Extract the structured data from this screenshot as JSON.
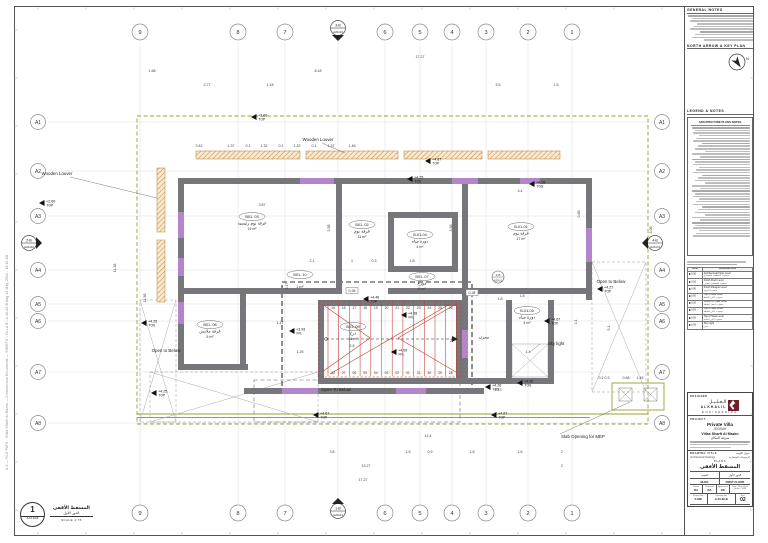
{
  "colors": {
    "wall": "#76767b",
    "purple": "#b286c8",
    "olive": "#9aa031",
    "red": "#c4382f",
    "hatch": "#cf8b3e",
    "hatch_bg": "#f7ead2",
    "logo": "#6e1f2a"
  },
  "sheet": {
    "file_path": "A-2  —  FILE PATH : Villas Sharft Al Mazkn — Construction Documents — SHEETS \\ VILLA B \\ A-10-02-B.dwg   13 May, 2014 - 10:15 AM"
  },
  "grid": {
    "top": [
      "9",
      "8",
      "7",
      "6",
      "5",
      "4",
      "3",
      "2",
      "1"
    ],
    "bottom": [
      "9",
      "8",
      "7",
      "6",
      "5",
      "4",
      "3",
      "2",
      "1"
    ],
    "left": [
      "A1",
      "A2",
      "A3",
      "A4",
      "A5",
      "A6",
      "A7",
      "A8"
    ],
    "right": [
      "A1",
      "A2",
      "A3",
      "A4",
      "A5",
      "A6",
      "A7",
      "A8"
    ],
    "section_markers": [
      {
        "name": "3-B",
        "ref": "A20-03",
        "dir": "down",
        "x": 338,
        "y": 28
      },
      {
        "name": "1-B",
        "ref": "A20-01",
        "dir": "up",
        "x": 338,
        "y": 511
      },
      {
        "name": "2-B",
        "ref": "A20-02",
        "dir": "right",
        "x": 29,
        "y": 243
      },
      {
        "name": "4-B",
        "ref": "A20-04",
        "dir": "left",
        "x": 655,
        "y": 243
      }
    ],
    "ref_tag": {
      "top": "1-B",
      "bot": "A30-01",
      "x": 498,
      "y": 277
    }
  },
  "plan": {
    "labels": [
      {
        "id": "wooden-louver-top",
        "t": "Wooden Louver",
        "x": 318,
        "y": 141
      },
      {
        "id": "wooden-louver-left",
        "t": "Wooden Louver",
        "x": 57,
        "y": 175
      },
      {
        "id": "open-below-left",
        "t": "Open to Below",
        "x": 166,
        "y": 352
      },
      {
        "id": "open-below-bottom",
        "t": "Open To Below",
        "x": 336,
        "y": 391
      },
      {
        "id": "open-below-right",
        "t": "Open to Below",
        "x": 611,
        "y": 283
      },
      {
        "id": "sky-light",
        "t": "Sky light",
        "x": 556,
        "y": 345
      },
      {
        "id": "slab-mep",
        "t": "Slab Opening for MEP",
        "x": 583,
        "y": 438
      }
    ],
    "rooms": [
      {
        "id": "B01- 03",
        "name": "غرفة نوم رئيسية",
        "area": "19 m²",
        "x": 252,
        "y": 218
      },
      {
        "id": "B01- 02",
        "name": "غرفة نوم",
        "area": "11 m²",
        "x": 362,
        "y": 226
      },
      {
        "id": "B-01-04",
        "name": "دورة مياه",
        "area": "4 m²",
        "x": 420,
        "y": 236
      },
      {
        "id": "B-01-01",
        "name": "غرفة نوم",
        "area": "17 m²",
        "x": 521,
        "y": 228
      },
      {
        "id": "B01- 07",
        "name": "موزع",
        "area": "5 m²",
        "x": 422,
        "y": 278
      },
      {
        "id": "B01- 10",
        "name": "",
        "area": "1 m²",
        "x": 300,
        "y": 276
      },
      {
        "id": "B01- 08",
        "name": "غرفة ملابس",
        "area": "5 m²",
        "x": 210,
        "y": 326
      },
      {
        "id": "B01- 09",
        "name": "درج",
        "area": "16 m²",
        "x": 353,
        "y": 328
      },
      {
        "id": "",
        "name": "مخزن",
        "area": "",
        "x": 484,
        "y": 332
      },
      {
        "id": "B-01-05",
        "name": "دورة مياه",
        "area": "4 m²",
        "x": 527,
        "y": 312
      }
    ],
    "level_markers": [
      {
        "v": "+2.68",
        "s": "TOP",
        "x": 258,
        "y": 113
      },
      {
        "v": "+2.60",
        "s": "TOP",
        "x": 46,
        "y": 199
      },
      {
        "v": "+4.87",
        "s": "TOP",
        "x": 432,
        "y": 157
      },
      {
        "v": "+4.25",
        "s": "TOS",
        "x": 414,
        "y": 175
      },
      {
        "v": "+4.26",
        "s": "TOS",
        "x": 536,
        "y": 180
      },
      {
        "v": "+4.25",
        "s": "TOS",
        "x": 148,
        "y": 319
      },
      {
        "v": "+4.46",
        "s": "TOP",
        "x": 370,
        "y": 295
      },
      {
        "v": "+4.38",
        "s": "FFL",
        "x": 408,
        "y": 311
      },
      {
        "v": "+3.93",
        "s": "FFL",
        "x": 296,
        "y": 327
      },
      {
        "v": "+4.09",
        "s": "FFL",
        "x": 398,
        "y": 348
      },
      {
        "v": "+4.27",
        "s": "TOP",
        "x": 604,
        "y": 285
      },
      {
        "v": "+4.67",
        "s": "TOP",
        "x": 551,
        "y": 317
      },
      {
        "v": "+4.26",
        "s": "TOS",
        "x": 492,
        "y": 383
      },
      {
        "v": "+4.67",
        "s": "TOP",
        "x": 320,
        "y": 411
      },
      {
        "v": "+4.67",
        "s": "TOP",
        "x": 498,
        "y": 411
      },
      {
        "v": "+4.25",
        "s": "TOP",
        "x": 158,
        "y": 389
      },
      {
        "v": "+4.25",
        "s": "TOS",
        "x": 524,
        "y": 379
      }
    ],
    "dimensions": [
      {
        "t": "17.27",
        "x": 420,
        "y": 58
      },
      {
        "t": "1.68",
        "x": 152,
        "y": 72
      },
      {
        "t": "8.18",
        "x": 318,
        "y": 72
      },
      {
        "t": "3.77",
        "x": 207,
        "y": 86
      },
      {
        "t": "1.18",
        "x": 270,
        "y": 86
      },
      {
        "t": "3.5",
        "x": 498,
        "y": 86
      },
      {
        "t": "1.5",
        "x": 556,
        "y": 86
      },
      {
        "t": "3.42",
        "x": 199,
        "y": 147
      },
      {
        "t": "1.37",
        "x": 231,
        "y": 147
      },
      {
        "t": "0.1",
        "x": 248,
        "y": 147
      },
      {
        "t": "1.32",
        "x": 264,
        "y": 147
      },
      {
        "t": "0.1",
        "x": 281,
        "y": 147
      },
      {
        "t": "1.32",
        "x": 297,
        "y": 147
      },
      {
        "t": "0.1",
        "x": 314,
        "y": 147
      },
      {
        "t": "1.37",
        "x": 331,
        "y": 147
      },
      {
        "t": "1.46",
        "x": 352,
        "y": 147
      },
      {
        "t": "3.87",
        "x": 262,
        "y": 206
      },
      {
        "t": "3.58",
        "x": 330,
        "y": 228,
        "r": 1
      },
      {
        "t": "3.38",
        "x": 452,
        "y": 228,
        "r": 1
      },
      {
        "t": "3.4",
        "x": 520,
        "y": 192
      },
      {
        "t": "0.88",
        "x": 580,
        "y": 214,
        "r": 1
      },
      {
        "t": "2.1",
        "x": 312,
        "y": 262
      },
      {
        "t": "1",
        "x": 352,
        "y": 262
      },
      {
        "t": "0.3",
        "x": 374,
        "y": 262
      },
      {
        "t": "1.8",
        "x": 412,
        "y": 262
      },
      {
        "t": "1.8",
        "x": 500,
        "y": 300
      },
      {
        "t": "2.8",
        "x": 352,
        "y": 347
      },
      {
        "t": "1.25",
        "x": 300,
        "y": 353
      },
      {
        "t": "1.47",
        "x": 280,
        "y": 324
      },
      {
        "t": "3.17",
        "x": 288,
        "y": 286,
        "r": 1
      },
      {
        "t": "1.4",
        "x": 528,
        "y": 353
      },
      {
        "t": "1.8",
        "x": 522,
        "y": 297
      },
      {
        "t": "5.1",
        "x": 610,
        "y": 328,
        "r": 1
      },
      {
        "t": "4.73",
        "x": 498,
        "y": 391
      },
      {
        "t": "1.45",
        "x": 640,
        "y": 379
      },
      {
        "t": "0.2 0.3",
        "x": 604,
        "y": 379
      },
      {
        "t": "0.68",
        "x": 626,
        "y": 379
      },
      {
        "t": "12.4",
        "x": 428,
        "y": 437
      },
      {
        "t": "3.8",
        "x": 332,
        "y": 453
      },
      {
        "t": "1.5",
        "x": 408,
        "y": 453
      },
      {
        "t": "0.9",
        "x": 430,
        "y": 453
      },
      {
        "t": "1.8",
        "x": 472,
        "y": 453
      },
      {
        "t": "1.6",
        "x": 520,
        "y": 453
      },
      {
        "t": "2",
        "x": 562,
        "y": 453
      },
      {
        "t": "13.27",
        "x": 366,
        "y": 467
      },
      {
        "t": "2",
        "x": 562,
        "y": 467
      },
      {
        "t": "17.27",
        "x": 363,
        "y": 481
      },
      {
        "t": "11.38",
        "x": 116,
        "y": 268,
        "r": 1
      },
      {
        "t": "11.38",
        "x": 146,
        "y": 298,
        "r": 1
      },
      {
        "t": "3.08",
        "x": 652,
        "y": 230,
        "r": 1
      },
      {
        "t": "3.1",
        "x": 577,
        "y": 322,
        "r": 1
      }
    ],
    "stairs": {
      "top_steps": [
        "15",
        "16",
        "17",
        "18",
        "19",
        "20",
        "21",
        "22",
        "23",
        "24",
        "25",
        "26"
      ],
      "bottom_steps": [
        "12",
        "07",
        "06",
        "05",
        "04",
        "03",
        "02",
        "01",
        "31",
        "30",
        "29",
        "28"
      ],
      "mid_step": "27"
    },
    "door_tags": [
      {
        "t": "D-06",
        "x": 352,
        "y": 291
      },
      {
        "t": "D-08",
        "x": 472,
        "y": 293
      }
    ]
  },
  "sidebar": {
    "general_notes_title": "GENERAL NOTES",
    "north_arrow_title": "NORTH ARROW & KEY PLAN",
    "north_letter": "N",
    "legend_title": "LEGEND & NOTES",
    "plan_notes_title": "ARCHITECTURE PLANS NOTES",
    "legend_table": {
      "col_sym": "SYM.",
      "col_desc": "DESCRIPTION",
      "rows": [
        {
          "sym": "0.00",
          "en": "Architectural Floor Level",
          "ar": "منسوب التشطيب المعماري"
        },
        {
          "sym": "0.00",
          "en": "Finish Floor Level",
          "ar": "منسوب التشطيب النهائي"
        },
        {
          "sym": "0.00",
          "en": "Finish Parapet Level",
          "ar": "منسوب الدروة"
        },
        {
          "sym": "0.00",
          "en": "Top of Wall Level",
          "ar": "منسوب أعلى الحائط"
        },
        {
          "sym": "0.00",
          "en": "Bottom of Slab Level",
          "ar": "منسوب أسفل البلاطة"
        },
        {
          "sym": "0.00",
          "en": "Top of Slab Level",
          "ar": "منسوب أعلى البلاطة"
        },
        {
          "sym": "0.00",
          "en": "Top of Steel Level",
          "ar": "منسوب أعلى الحديد"
        },
        {
          "sym": "0.00",
          "en": "Sky Light",
          "ar": "منور"
        }
      ]
    }
  },
  "titleblock": {
    "designer_label": "DESIGNER",
    "logo_ar": "الـخـلـيـل",
    "logo_en": "ALKHALIL",
    "logo_sub": "ENGINEERING",
    "project_label": "PROJECT",
    "project_name": "Private Villa",
    "project_city": "JEDDAH",
    "project_line2": "Villas Sharft Al Mazkn",
    "project_line2_ar": "شرفة المكان",
    "drawing_title_label": "DRAWING TITLE",
    "drawing_title_label_ar": "عنوان اللوحة",
    "category_en": "Architectural Drawings",
    "category_ar": "الرسومات المعمارية",
    "series": "PLANS",
    "title_ar": "المسقط الأفقي",
    "sub_left_ar": "المبنى",
    "sub_right_ar": "الدور الأول",
    "bldg_label": "BLDG",
    "floor_label": "FIRST FLOOR",
    "drawn_label": "Drawn",
    "checked_label": "Checked",
    "approved_label": "Approved",
    "date_label": "Date :",
    "drawn": "DA",
    "checked": "DA",
    "approved": "HK",
    "date_value": "May 2014",
    "scale_label": "Scale :",
    "scale_value": "1:75",
    "projno_label": "Project No.",
    "projno": "F-830",
    "dwgno_label": "Drawing No.",
    "dwgno": "A-10-02-B",
    "rev_label": "Rev.",
    "rev": "02"
  },
  "viewtitle": {
    "number": "1",
    "ref": "A-10-02-B",
    "title_ar": "المسقط الأفقي",
    "subtitle_ar": "الدور الأول",
    "scale": "SCALE  1:75"
  }
}
